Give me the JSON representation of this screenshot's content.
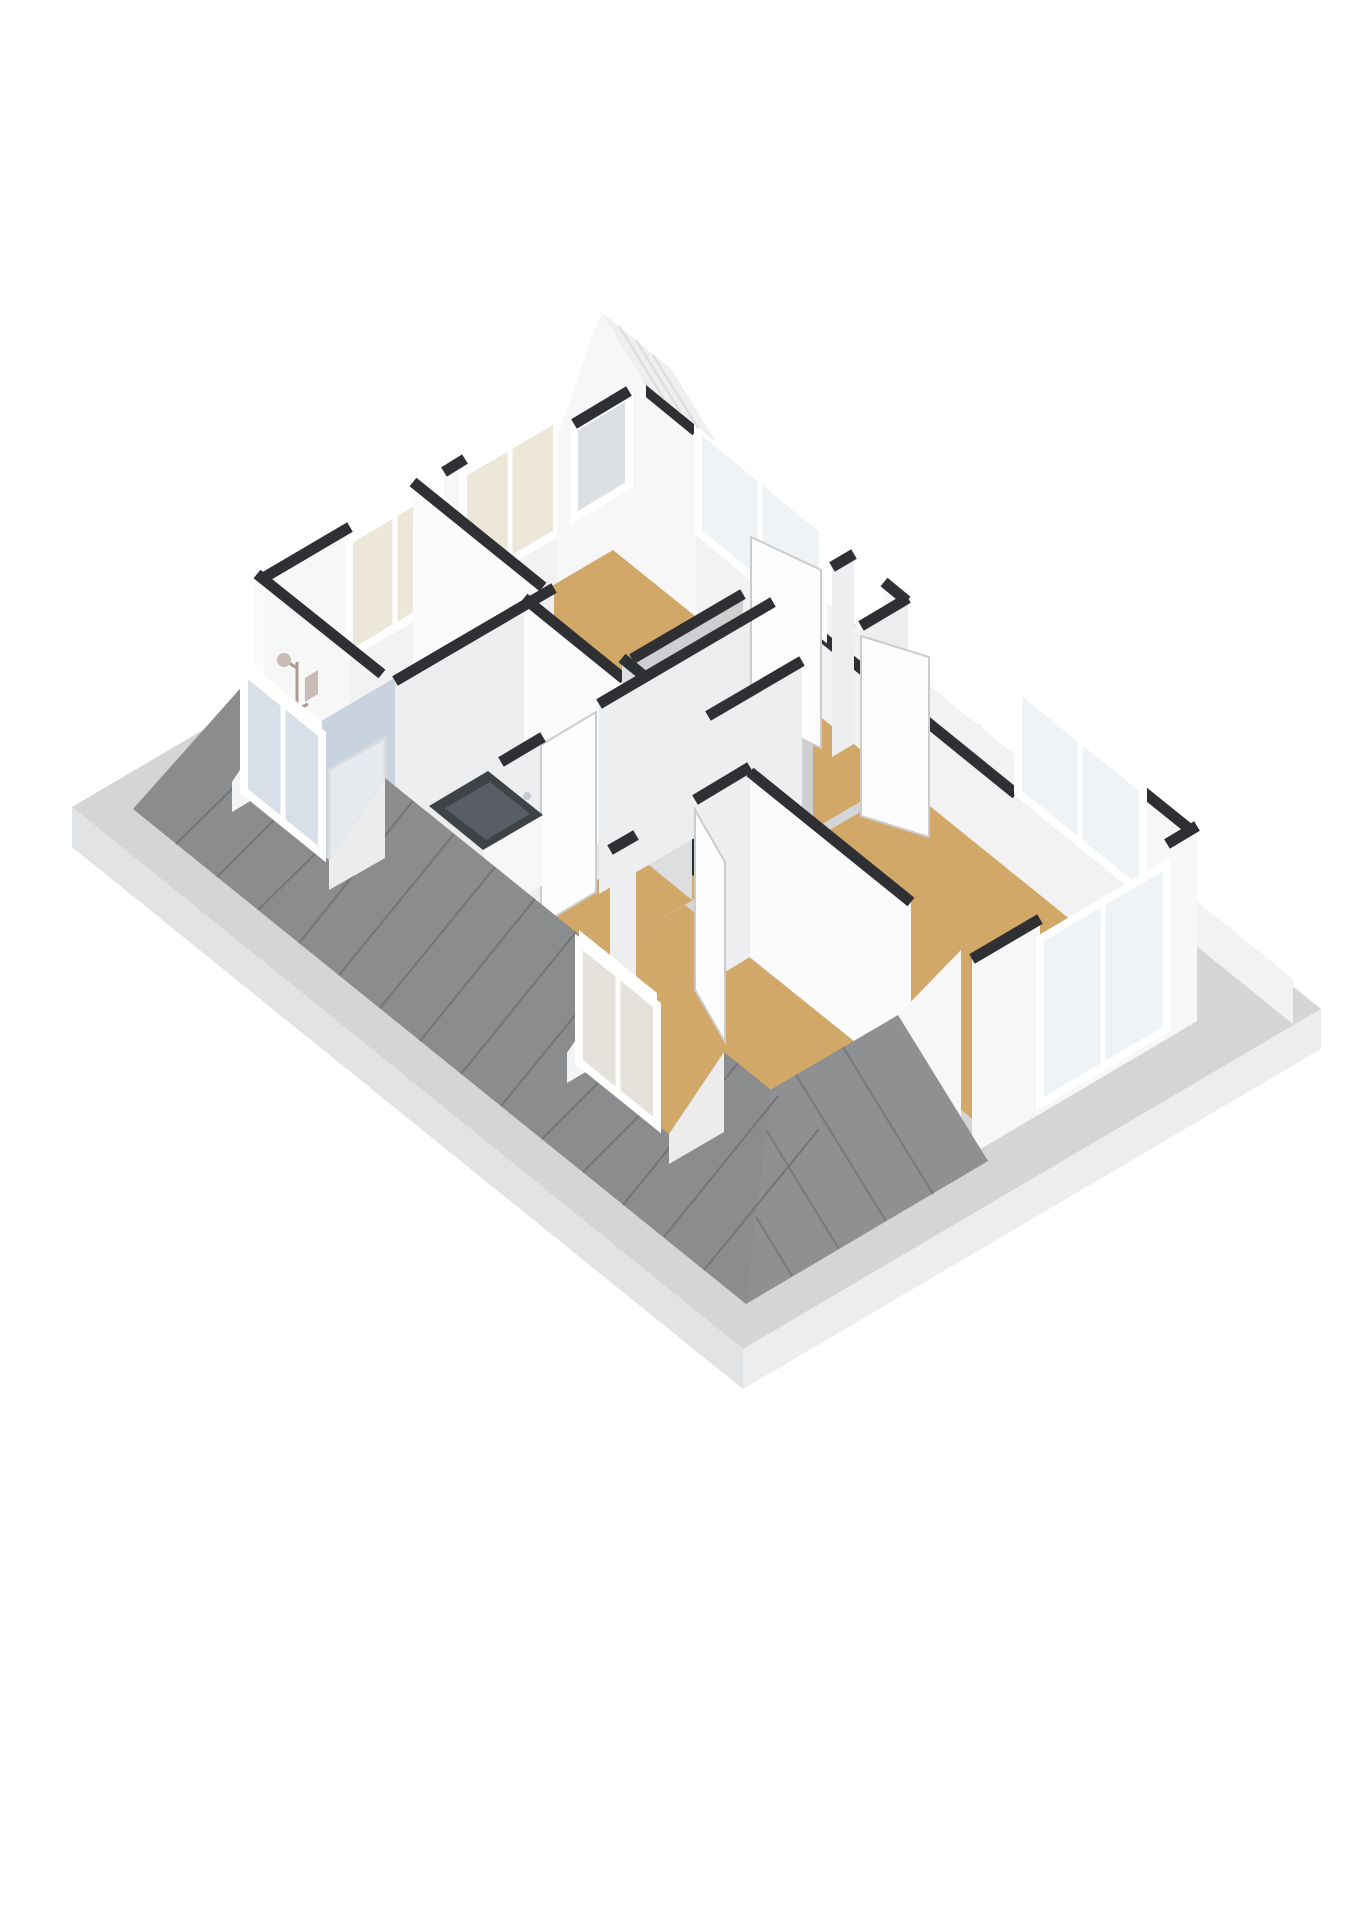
{
  "title": "3D attic floorplan render",
  "colors": {
    "bg": "#ffffff",
    "rim": "#d4d5d6",
    "fascia_sw": "#e2e3e4",
    "fascia_se": "#ededee",
    "fascia_ne": "#f2f2f3",
    "roof_sw": "#8a8c8e",
    "roof_sw_seam": "#737577",
    "roof_se": "#8f9092",
    "roof_se_seam": "#77797b",
    "roof_ne_band": "#ececec",
    "roof_ne_seam": "#d8d8d8",
    "gable_roof": "#efefef",
    "gable_roof_seam": "#dcdcdc",
    "wall_white": "#f7f7f7",
    "wall_bright": "#fbfbfb",
    "wall_shaded": "#edeeef",
    "wall_knee": "#f2f2f2",
    "wall_cheek_lit": "#f4f4f4",
    "wall_cheek_dark": "#ececec",
    "wall_top": "#2e3033",
    "enclosure_light": "#dddee0",
    "enclosure_dark": "#cdcfd1",
    "stair_void": "#2b2e31",
    "floor_wood": "#d2a868",
    "floor_bath": "#c9d3de",
    "floor_utility": "#e4e7ea",
    "glass_cream": "#ede7da",
    "glass_clear": "#eff3f5",
    "glass_blue": "#d7e0e8",
    "glass_warm": "#e4e2db",
    "glass_gray": "#dde0e2",
    "frame_white": "#ffffff",
    "door_white": "#fdfdfd",
    "door_edge": "#cccccc",
    "sink_dark": "#3e4347",
    "sink_rim": "#585e63",
    "shower_metal": "#ad9a94",
    "shower_head": "#c9bcb7",
    "screen_edge": "#d9dcdf"
  },
  "scene": {
    "view": "isometric-3d",
    "storey": "attic",
    "rooms": [
      {
        "id": "bathroom",
        "floor": "floor_bath"
      },
      {
        "id": "utility-room",
        "floor": "floor_utility"
      },
      {
        "id": "bedroom-top",
        "floor": "floor_wood"
      },
      {
        "id": "bedroom-right",
        "floor": "floor_wood"
      },
      {
        "id": "bedroom-bottom",
        "floor": "floor_wood"
      },
      {
        "id": "landing-hall",
        "floor": "floor_wood"
      },
      {
        "id": "stairwell",
        "floor": "stair_void"
      }
    ],
    "fixtures": [
      "shower-set",
      "shower-screen",
      "washbasin-vanity"
    ],
    "windows_count": 9,
    "doors_count": 4
  }
}
